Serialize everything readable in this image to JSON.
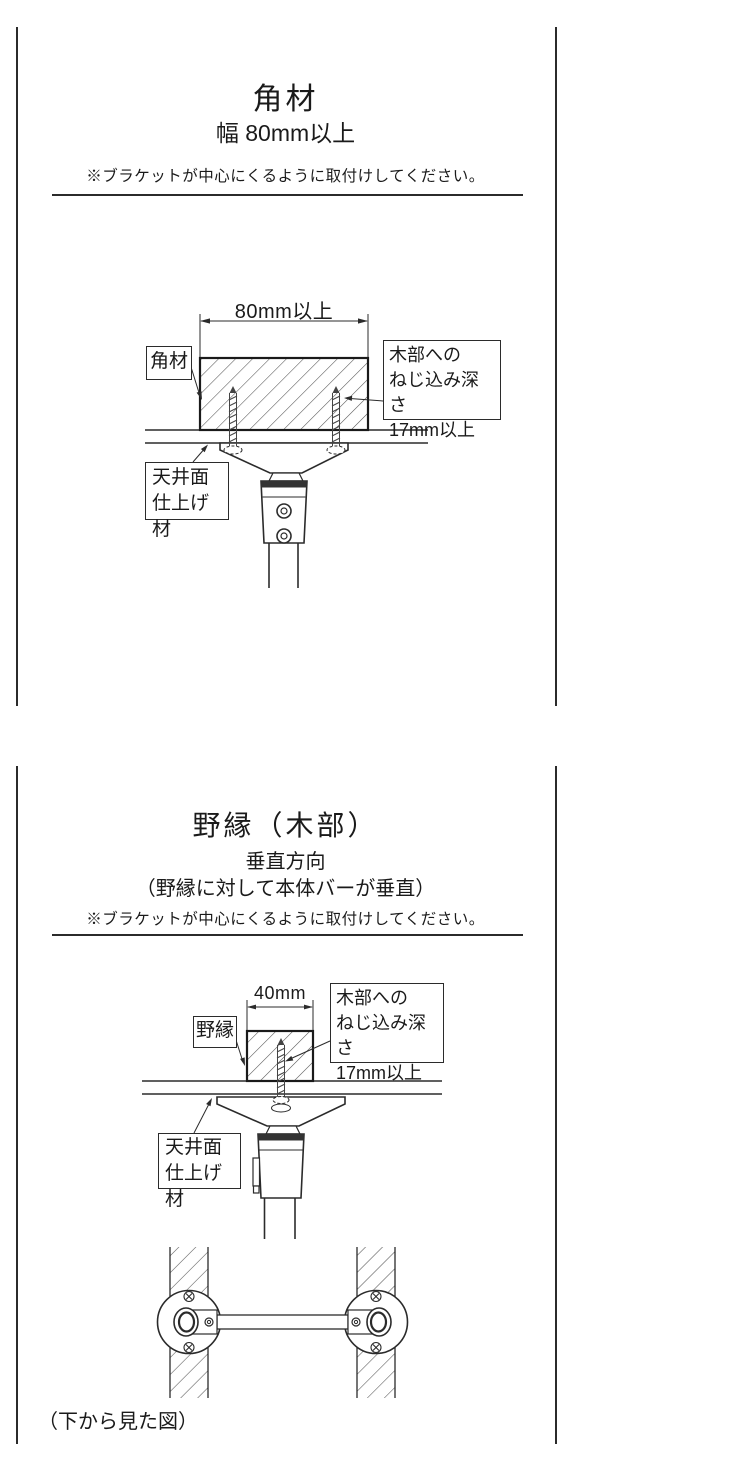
{
  "colors": {
    "background": "#ffffff",
    "line": "#2b2b2b"
  },
  "panel1": {
    "title": "角材",
    "subtitle": "幅 80mm以上",
    "note": "※ブラケットが中心にくるように取付けしてください。",
    "dimension_label": "80mm以上",
    "part_label": "角材",
    "screw_note": {
      "lines": [
        "木部への",
        "ねじ込み深さ",
        "17mm以上"
      ]
    },
    "ceiling_label": {
      "lines": [
        "天井面",
        "仕上げ材"
      ]
    }
  },
  "panel2": {
    "title": "野縁（木部）",
    "subtitle": "垂直方向",
    "orientation_note": "（野縁に対して本体バーが垂直）",
    "note": "※ブラケットが中心にくるように取付けしてください。",
    "dimension_label": "40mm",
    "part_label": "野縁",
    "screw_note": {
      "lines": [
        "木部への",
        "ねじ込み深さ",
        "17mm以上"
      ]
    },
    "ceiling_label": {
      "lines": [
        "天井面",
        "仕上げ材"
      ]
    },
    "bottom_view_caption": "（下から見た図）"
  }
}
